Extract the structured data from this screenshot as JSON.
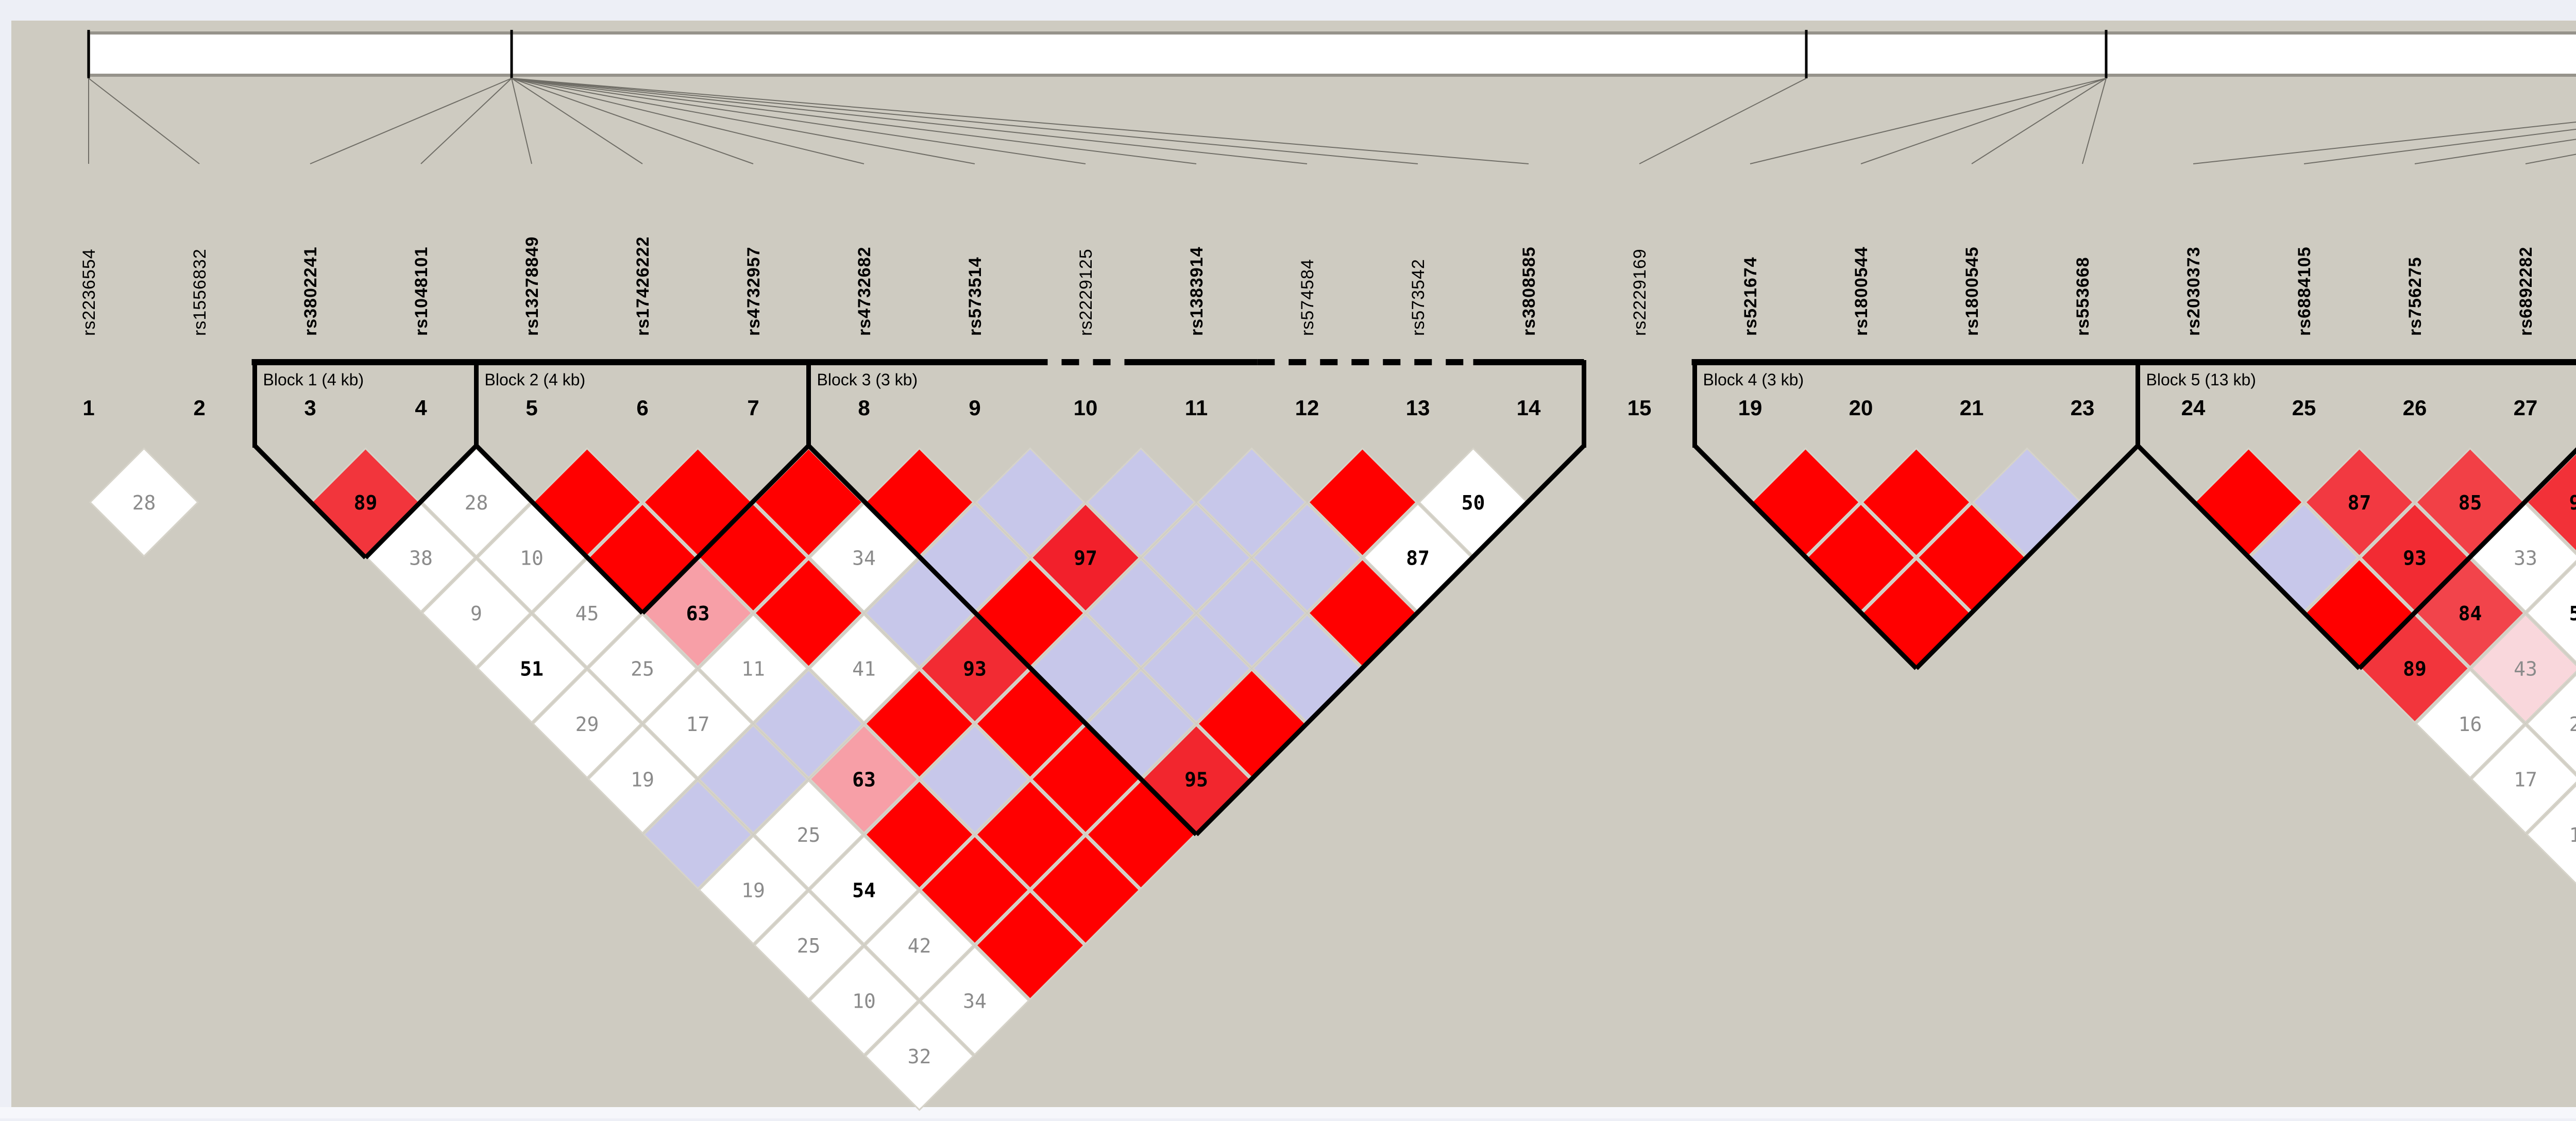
{
  "app": {
    "name": "haploview-ld-plot",
    "background_color": "#cecbc1",
    "frame_color": "#edeff6",
    "block_border_color": "#000000",
    "cell_stroke_color": "#d6d3c9",
    "ruler": {
      "bar_fill": "#ffffff",
      "bar_border": "#96938b",
      "tick_color": "#000000",
      "connector_color": "#6f6d66",
      "ticks_x": [
        172,
        993,
        3506,
        4088,
        5778
      ],
      "tick_targets": [
        [
          1,
          2
        ],
        [
          3,
          4,
          5,
          6,
          7,
          8,
          9,
          10,
          11,
          12,
          13,
          14
        ],
        [
          15
        ],
        [
          16,
          17,
          18,
          19
        ],
        [
          20,
          21,
          22,
          23,
          24,
          25,
          26,
          27
        ]
      ]
    }
  },
  "chart_data": {
    "type": "heatmap",
    "subtype": "haploview-ld-triangle",
    "value_semantics": "pairwise D' x100; empty red = 100 (strong LD), blue = D'=1 low LOD, white = low LD",
    "palette": {
      "r": "#ff0000",
      "b": "#c7c7ea",
      "w": "#ffffff",
      "shade_by_value": {
        "97": "#f2202b",
        "95": "#f2262e",
        "93": "#f22b33",
        "90": "#f23138",
        "89": "#f2353c",
        "87": "#f23941",
        "85": "#f24046",
        "84": "#f2444b",
        "63": "#f79fa7",
        "43": "#f9d7dc"
      },
      "text_high": "#000000",
      "text_low": "#8b8b8b"
    },
    "markers": [
      {
        "col": 1,
        "num": "1",
        "rs": "rs2236554",
        "bold": false
      },
      {
        "col": 2,
        "num": "2",
        "rs": "rs1556832",
        "bold": false
      },
      {
        "col": 3,
        "num": "3",
        "rs": "rs3802241",
        "bold": true
      },
      {
        "col": 4,
        "num": "4",
        "rs": "rs1048101",
        "bold": true
      },
      {
        "col": 5,
        "num": "5",
        "rs": "rs13278849",
        "bold": true
      },
      {
        "col": 6,
        "num": "6",
        "rs": "rs17426222",
        "bold": true
      },
      {
        "col": 7,
        "num": "7",
        "rs": "rs4732957",
        "bold": true
      },
      {
        "col": 8,
        "num": "8",
        "rs": "rs4732682",
        "bold": true
      },
      {
        "col": 9,
        "num": "9",
        "rs": "rs573514",
        "bold": true
      },
      {
        "col": 10,
        "num": "10",
        "rs": "rs2229125",
        "bold": false
      },
      {
        "col": 11,
        "num": "11",
        "rs": "rs1383914",
        "bold": true
      },
      {
        "col": 12,
        "num": "12",
        "rs": "rs574584",
        "bold": false
      },
      {
        "col": 13,
        "num": "13",
        "rs": "rs573542",
        "bold": false
      },
      {
        "col": 14,
        "num": "14",
        "rs": "rs3808585",
        "bold": true
      },
      {
        "col": 15,
        "num": "15",
        "rs": "rs2229169",
        "bold": false
      },
      {
        "col": 16,
        "num": "19",
        "rs": "rs521674",
        "bold": true
      },
      {
        "col": 17,
        "num": "20",
        "rs": "rs1800544",
        "bold": true
      },
      {
        "col": 18,
        "num": "21",
        "rs": "rs1800545",
        "bold": true
      },
      {
        "col": 19,
        "num": "23",
        "rs": "rs553668",
        "bold": true
      },
      {
        "col": 20,
        "num": "24",
        "rs": "rs2030373",
        "bold": true
      },
      {
        "col": 21,
        "num": "25",
        "rs": "rs6884105",
        "bold": true
      },
      {
        "col": 22,
        "num": "26",
        "rs": "rs756275",
        "bold": true
      },
      {
        "col": 23,
        "num": "27",
        "rs": "rs6892282",
        "bold": true
      },
      {
        "col": 24,
        "num": "28",
        "rs": "rs10515807",
        "bold": true
      },
      {
        "col": 25,
        "num": "29",
        "rs": "rs6888306",
        "bold": true
      },
      {
        "col": 26,
        "num": "30",
        "rs": "rs13162302",
        "bold": true
      },
      {
        "col": 27,
        "num": "31",
        "rs": "rs11750092",
        "bold": true
      }
    ],
    "blocks": [
      {
        "label": "Block 1 (4 kb)",
        "a": 3,
        "b": 4
      },
      {
        "label": "Block 2 (4 kb)",
        "a": 5,
        "b": 7
      },
      {
        "label": "Block 3 (3 kb)",
        "a": 8,
        "b": 14,
        "top_segments": [
          [
            7.5,
            9.5,
            "solid"
          ],
          [
            9.5,
            10.5,
            "dash"
          ],
          [
            10.5,
            11.55,
            "solid"
          ],
          [
            11.55,
            13.5,
            "dash"
          ],
          [
            13.5,
            14.5,
            "solid"
          ]
        ]
      },
      {
        "label": "Block 4 (3 kb)",
        "a": 16,
        "b": 19
      },
      {
        "label": "Block 5 (13 kb)",
        "a": 20,
        "b": 23
      },
      {
        "label": "Block 6 (2 kb)",
        "a": 24,
        "b": 27
      }
    ],
    "cells": [
      {
        "a": 1,
        "b": 2,
        "v": 28,
        "t": "w"
      },
      {
        "a": 3,
        "b": 4,
        "v": 89,
        "t": "s"
      },
      {
        "a": 4,
        "b": 5,
        "v": 28,
        "t": "w"
      },
      {
        "a": 5,
        "b": 6,
        "t": "r"
      },
      {
        "a": 6,
        "b": 7,
        "t": "r"
      },
      {
        "a": 7,
        "b": 8,
        "t": "r"
      },
      {
        "a": 8,
        "b": 9,
        "t": "r"
      },
      {
        "a": 9,
        "b": 10,
        "t": "b"
      },
      {
        "a": 10,
        "b": 11,
        "t": "b"
      },
      {
        "a": 11,
        "b": 12,
        "t": "b"
      },
      {
        "a": 12,
        "b": 13,
        "t": "r"
      },
      {
        "a": 13,
        "b": 14,
        "v": 50,
        "t": "w"
      },
      {
        "a": 3,
        "b": 5,
        "v": 38,
        "t": "w"
      },
      {
        "a": 4,
        "b": 6,
        "v": 10,
        "t": "w"
      },
      {
        "a": 5,
        "b": 7,
        "t": "r"
      },
      {
        "a": 6,
        "b": 8,
        "t": "r"
      },
      {
        "a": 7,
        "b": 9,
        "v": 34,
        "t": "w"
      },
      {
        "a": 8,
        "b": 10,
        "t": "b"
      },
      {
        "a": 9,
        "b": 11,
        "v": 97,
        "t": "s"
      },
      {
        "a": 10,
        "b": 12,
        "t": "b"
      },
      {
        "a": 11,
        "b": 13,
        "t": "b"
      },
      {
        "a": 12,
        "b": 14,
        "v": 87,
        "t": "w"
      },
      {
        "a": 3,
        "b": 6,
        "v": 9,
        "t": "w"
      },
      {
        "a": 4,
        "b": 7,
        "v": 45,
        "t": "w"
      },
      {
        "a": 5,
        "b": 8,
        "v": 63,
        "t": "s"
      },
      {
        "a": 6,
        "b": 9,
        "t": "r"
      },
      {
        "a": 7,
        "b": 10,
        "t": "b"
      },
      {
        "a": 8,
        "b": 11,
        "t": "r"
      },
      {
        "a": 9,
        "b": 12,
        "t": "b"
      },
      {
        "a": 10,
        "b": 13,
        "t": "b"
      },
      {
        "a": 11,
        "b": 14,
        "t": "r"
      },
      {
        "a": 3,
        "b": 7,
        "v": 51,
        "t": "w"
      },
      {
        "a": 4,
        "b": 8,
        "v": 25,
        "t": "w"
      },
      {
        "a": 5,
        "b": 9,
        "v": 11,
        "t": "w"
      },
      {
        "a": 6,
        "b": 10,
        "v": 41,
        "t": "w"
      },
      {
        "a": 7,
        "b": 11,
        "v": 93,
        "t": "s"
      },
      {
        "a": 8,
        "b": 12,
        "t": "b"
      },
      {
        "a": 9,
        "b": 13,
        "t": "b"
      },
      {
        "a": 10,
        "b": 14,
        "t": "b"
      },
      {
        "a": 3,
        "b": 8,
        "v": 29,
        "t": "w"
      },
      {
        "a": 4,
        "b": 9,
        "v": 17,
        "t": "w"
      },
      {
        "a": 5,
        "b": 10,
        "t": "b"
      },
      {
        "a": 6,
        "b": 11,
        "t": "r"
      },
      {
        "a": 7,
        "b": 12,
        "t": "r"
      },
      {
        "a": 8,
        "b": 13,
        "t": "b"
      },
      {
        "a": 9,
        "b": 14,
        "t": "r"
      },
      {
        "a": 3,
        "b": 9,
        "v": 19,
        "t": "w"
      },
      {
        "a": 4,
        "b": 10,
        "t": "b"
      },
      {
        "a": 5,
        "b": 11,
        "v": 63,
        "t": "s"
      },
      {
        "a": 6,
        "b": 12,
        "t": "b"
      },
      {
        "a": 7,
        "b": 13,
        "t": "r"
      },
      {
        "a": 8,
        "b": 14,
        "v": 95,
        "t": "s"
      },
      {
        "a": 3,
        "b": 10,
        "t": "b"
      },
      {
        "a": 4,
        "b": 11,
        "v": 25,
        "t": "w"
      },
      {
        "a": 5,
        "b": 12,
        "t": "r"
      },
      {
        "a": 6,
        "b": 13,
        "t": "r"
      },
      {
        "a": 7,
        "b": 14,
        "t": "r"
      },
      {
        "a": 3,
        "b": 11,
        "v": 19,
        "t": "w"
      },
      {
        "a": 4,
        "b": 12,
        "v": 54,
        "t": "w"
      },
      {
        "a": 5,
        "b": 13,
        "t": "r"
      },
      {
        "a": 6,
        "b": 14,
        "t": "r"
      },
      {
        "a": 3,
        "b": 12,
        "v": 25,
        "t": "w"
      },
      {
        "a": 4,
        "b": 13,
        "v": 42,
        "t": "w"
      },
      {
        "a": 5,
        "b": 14,
        "t": "r"
      },
      {
        "a": 3,
        "b": 13,
        "v": 10,
        "t": "w"
      },
      {
        "a": 4,
        "b": 14,
        "v": 34,
        "t": "w"
      },
      {
        "a": 3,
        "b": 14,
        "v": 32,
        "t": "w"
      },
      {
        "a": 16,
        "b": 17,
        "t": "r"
      },
      {
        "a": 17,
        "b": 18,
        "t": "r"
      },
      {
        "a": 18,
        "b": 19,
        "t": "b"
      },
      {
        "a": 16,
        "b": 18,
        "t": "r"
      },
      {
        "a": 17,
        "b": 19,
        "t": "r"
      },
      {
        "a": 16,
        "b": 19,
        "t": "r"
      },
      {
        "a": 20,
        "b": 21,
        "t": "r"
      },
      {
        "a": 21,
        "b": 22,
        "v": 87,
        "t": "s"
      },
      {
        "a": 22,
        "b": 23,
        "v": 85,
        "t": "s"
      },
      {
        "a": 23,
        "b": 24,
        "v": 90,
        "t": "s"
      },
      {
        "a": 24,
        "b": 25,
        "t": "r"
      },
      {
        "a": 25,
        "b": 26,
        "t": "r"
      },
      {
        "a": 26,
        "b": 27,
        "t": "r"
      },
      {
        "a": 20,
        "b": 22,
        "t": "b"
      },
      {
        "a": 21,
        "b": 23,
        "v": 93,
        "t": "s"
      },
      {
        "a": 22,
        "b": 24,
        "v": 33,
        "t": "w"
      },
      {
        "a": 23,
        "b": 25,
        "t": "r"
      },
      {
        "a": 24,
        "b": 26,
        "t": "r"
      },
      {
        "a": 25,
        "b": 27,
        "t": "r"
      },
      {
        "a": 20,
        "b": 23,
        "t": "r"
      },
      {
        "a": 21,
        "b": 24,
        "v": 84,
        "t": "s"
      },
      {
        "a": 22,
        "b": 25,
        "v": 55,
        "t": "w"
      },
      {
        "a": 23,
        "b": 26,
        "t": "r"
      },
      {
        "a": 24,
        "b": 27,
        "t": "r"
      },
      {
        "a": 20,
        "b": 24,
        "v": 89,
        "t": "s"
      },
      {
        "a": 21,
        "b": 25,
        "v": 43,
        "t": "s"
      },
      {
        "a": 22,
        "b": 26,
        "t": "b"
      },
      {
        "a": 23,
        "b": 27,
        "t": "r"
      },
      {
        "a": 20,
        "b": 25,
        "v": 16,
        "t": "w"
      },
      {
        "a": 21,
        "b": 26,
        "v": 29,
        "t": "w"
      },
      {
        "a": 22,
        "b": 27,
        "t": "b"
      },
      {
        "a": 20,
        "b": 26,
        "v": 17,
        "t": "w"
      },
      {
        "a": 21,
        "b": 27,
        "v": 28,
        "t": "w"
      },
      {
        "a": 20,
        "b": 27,
        "v": 19,
        "t": "w"
      }
    ]
  }
}
